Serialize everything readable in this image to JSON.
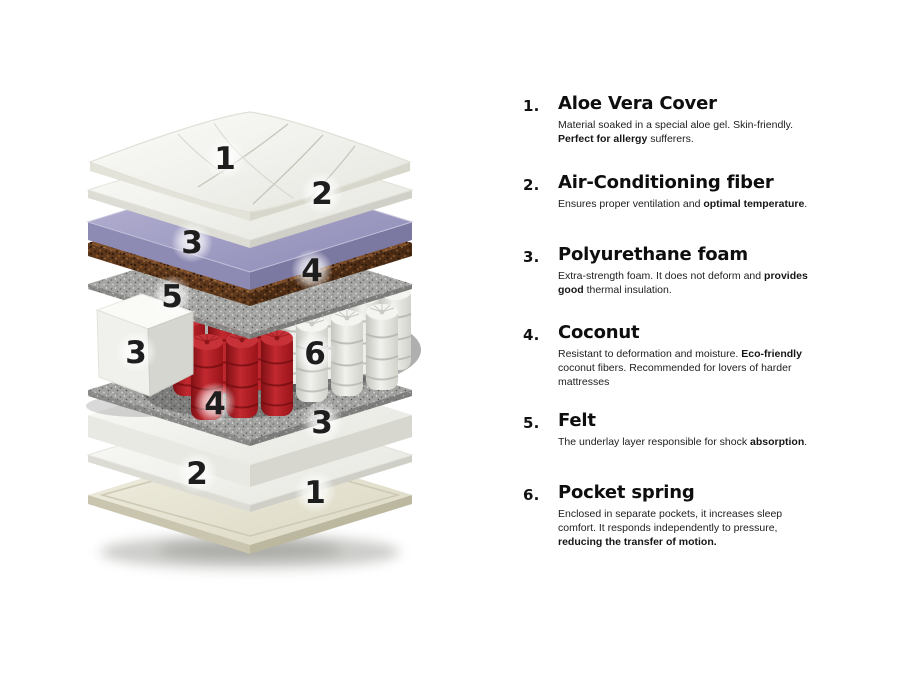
{
  "legend": {
    "items": [
      {
        "number": "1.",
        "title": "Aloe Vera Cover",
        "desc": [
          {
            "t": "Material soaked in a special aloe gel. Skin-friendly. "
          },
          {
            "t": "Perfect for allergy",
            "bold": true
          },
          {
            "t": " sufferers."
          }
        ]
      },
      {
        "number": "2.",
        "title": "Air-Conditioning fiber",
        "desc": [
          {
            "t": "Ensures proper ventilation and "
          },
          {
            "t": "optimal temperature",
            "bold": true
          },
          {
            "t": "."
          }
        ]
      },
      {
        "number": "3.",
        "title": "Polyurethane foam",
        "desc": [
          {
            "t": "Extra-strength foam. It does not deform and "
          },
          {
            "t": "provides good",
            "bold": true
          },
          {
            "t": " thermal insulation."
          }
        ]
      },
      {
        "number": "4.",
        "title": "Coconut",
        "desc": [
          {
            "t": "Resistant to deformation and moisture. "
          },
          {
            "t": "Eco-friendly",
            "bold": true
          },
          {
            "t": " coconut fibers. Recommended for lovers of harder mattresses"
          }
        ]
      },
      {
        "number": "5.",
        "title": "Felt",
        "desc": [
          {
            "t": "The underlay layer responsible for shock "
          },
          {
            "t": "absorption",
            "bold": true
          },
          {
            "t": "."
          }
        ]
      },
      {
        "number": "6.",
        "title": "Pocket spring",
        "desc": [
          {
            "t": "Enclosed in separate pockets, it increases sleep comfort. It responds independently to pressure, "
          },
          {
            "t": "reducing the transfer of motion.",
            "bold": true
          }
        ]
      }
    ]
  },
  "diagram": {
    "labels": [
      "1",
      "2",
      "3",
      "4",
      "5",
      "3",
      "6",
      "4",
      "3",
      "2",
      "1"
    ],
    "colors": {
      "purple_foam": "#9d9ac2",
      "coconut_brown": "#74482a",
      "felt_gray": "#9d9d9b",
      "spring_red": "#b01b20",
      "spring_white": "#e9e9e6",
      "cover_ivory": "#e9e6d7",
      "foam_white": "#f0f0ec",
      "label_text": "#1e1e1e"
    }
  }
}
